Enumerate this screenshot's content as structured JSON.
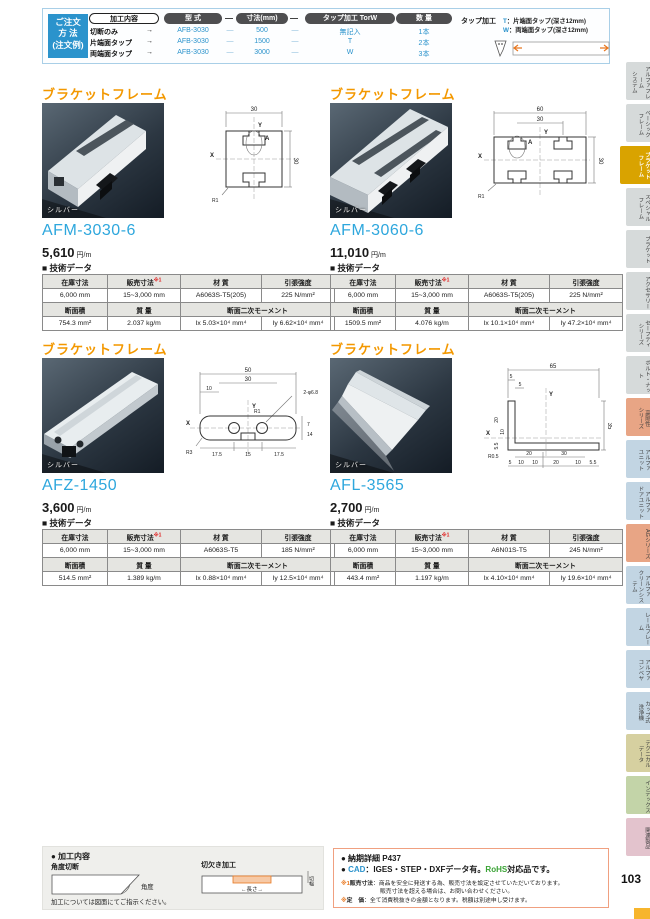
{
  "page": {
    "number": "103",
    "accent_orange": "#f39800",
    "accent_blue": "#2b93cc",
    "tab_active_bg": "#d9a300"
  },
  "order": {
    "box_label": "ご注文\n方 法\n(注文例)",
    "col_processing": "加工内容",
    "col_model": "型 式",
    "col_size": "寸法(mm)",
    "col_tap": "タップ加工 TorW",
    "col_qty": "数 量",
    "dash1": "—",
    "dash2": "—",
    "rows": [
      {
        "proc": "切断のみ",
        "arrow": "→",
        "model": "AFB-3030",
        "d1": "—",
        "size": "500",
        "d2": "—",
        "tap": "無記入",
        "qty": "1本"
      },
      {
        "proc": "片端面タップ",
        "arrow": "→",
        "model": "AFB-3030",
        "d1": "—",
        "size": "1500",
        "d2": "—",
        "tap": "T",
        "qty": "2本"
      },
      {
        "proc": "両端面タップ",
        "arrow": "→",
        "model": "AFB-3030",
        "d1": "—",
        "size": "3000",
        "d2": "—",
        "tap": "W",
        "qty": "3本"
      }
    ],
    "legend": {
      "title": "タップ加工",
      "t_key": "T",
      "t_text": "：片端面タップ(深さ12mm)",
      "w_key": "W",
      "w_text": "：両端面タップ(深さ12mm)"
    }
  },
  "products": [
    {
      "title": "ブラケットフレーム",
      "photo_label": "シルバー",
      "code": "AFM-3030-6",
      "price": "5,610",
      "unit": "円/m",
      "tech_heading": "■ 技術データ",
      "table": {
        "h1": "在庫寸法",
        "h2": "販売寸法",
        "h2_sup": "※1",
        "h3": "材 質",
        "h4": "引張強度",
        "v1": "6,000 mm",
        "v2": "15~3,000 mm",
        "v3": "A6063S-T5(205)",
        "v4": "225 N/mm²",
        "h5": "断面積",
        "h6": "質 量",
        "h7": "断面二次モーメント",
        "v5": "754.3 mm²",
        "v6": "2.037 kg/m",
        "v7a": "Ix 5.03×10⁴ mm⁴",
        "v7b": "Iy 6.62×10⁴ mm⁴"
      },
      "diagram": {
        "dim_w": "30",
        "dim_h": "30",
        "ax_x": "X",
        "ax_y": "Y",
        "pt_a": "A",
        "r": "R1"
      }
    },
    {
      "title": "ブラケットフレーム",
      "photo_label": "シルバー",
      "code": "AFM-3060-6",
      "price": "11,010",
      "unit": "円/m",
      "tech_heading": "■ 技術データ",
      "table": {
        "h1": "在庫寸法",
        "h2": "販売寸法",
        "h2_sup": "※1",
        "h3": "材 質",
        "h4": "引張強度",
        "v1": "6,000 mm",
        "v2": "15~3,000 mm",
        "v3": "A6063S-T5(205)",
        "v4": "225 N/mm²",
        "h5": "断面積",
        "h6": "質 量",
        "h7": "断面二次モーメント",
        "v5": "1509.5 mm²",
        "v6": "4.076 kg/m",
        "v7a": "Ix 10.1×10⁴ mm⁴",
        "v7b": "Iy 47.2×10⁴ mm⁴"
      },
      "diagram": {
        "dim_w": "60",
        "dim_inner": "30",
        "dim_h": "30",
        "ax_x": "X",
        "ax_y": "Y",
        "pt_a": "A",
        "r": "R1"
      }
    },
    {
      "title": "ブラケットフレーム",
      "photo_label": "シルバー",
      "code": "AFZ-1450",
      "price": "3,600",
      "unit": "円/m",
      "tech_heading": "■ 技術データ",
      "table": {
        "h1": "在庫寸法",
        "h2": "販売寸法",
        "h2_sup": "※1",
        "h3": "材 質",
        "h4": "引張強度",
        "v1": "6,000 mm",
        "v2": "15~3,000 mm",
        "v3": "A6063S-T5",
        "v4": "185 N/mm²",
        "h5": "断面積",
        "h6": "質 量",
        "h7": "断面二次モーメント",
        "v5": "514.5 mm²",
        "v6": "1.389 kg/m",
        "v7a": "Ix 0.88×10⁴ mm⁴",
        "v7b": "Iy 12.5×10⁴ mm⁴"
      },
      "diagram": {
        "dim_w": "50",
        "dim_mid": "30",
        "dim_s": "10",
        "hole": "2-φ6.8",
        "ax_x": "X",
        "ax_y": "Y",
        "b1": "17.5",
        "b2": "15",
        "b3": "17.5",
        "side": "14",
        "side2": "7",
        "r": "R3",
        "r2": "R1"
      }
    },
    {
      "title": "ブラケットフレーム",
      "photo_label": "シルバー",
      "code": "AFL-3565",
      "price": "2,700",
      "unit": "円/m",
      "tech_heading": "■ 技術データ",
      "table": {
        "h1": "在庫寸法",
        "h2": "販売寸法",
        "h2_sup": "※1",
        "h3": "材 質",
        "h4": "引張強度",
        "v1": "6,000 mm",
        "v2": "15~3,000 mm",
        "v3": "A6N01S-T5",
        "v4": "245 N/mm²",
        "h5": "断面積",
        "h6": "質 量",
        "h7": "断面二次モーメント",
        "v5": "443.4 mm²",
        "v6": "1.197 kg/m",
        "v7a": "Ix 4.10×10⁴ mm⁴",
        "v7b": "Iy 19.6×10⁴ mm⁴"
      },
      "diagram": {
        "dim_w": "65",
        "s1": "5",
        "s2": "5",
        "ax_x": "X",
        "ax_y": "Y",
        "side": "35",
        "b1": "20",
        "b2": "30",
        "c1": "5",
        "c2": "10",
        "c3": "10",
        "c4": "20",
        "c5": "10",
        "c6": "5.5",
        "l1": "20",
        "l2": "10",
        "l3": "5.5",
        "r": "R0.5"
      }
    }
  ],
  "sidebar": {
    "tabs": [
      {
        "label": "アルファフレーム\nシステム"
      },
      {
        "label": "ベーシック\nフレーム"
      },
      {
        "label": "ブラケット\nフレーム"
      },
      {
        "label": "スペシャル\nフレーム"
      },
      {
        "label": "ブラケット"
      },
      {
        "label": "アクセサリー"
      },
      {
        "label": "セーフティ\nシリーズ"
      },
      {
        "label": "ボルト・ナット"
      },
      {
        "label": "高剛性\nシリーズ"
      },
      {
        "label": "アルファ\nユニット"
      },
      {
        "label": "アルファ\nドアユニット"
      },
      {
        "label": "AGシリーズ"
      },
      {
        "label": "アルファ\nクリーンシステム"
      },
      {
        "label": "レールフレーム"
      },
      {
        "label": "アルファ\nコンベヤ"
      },
      {
        "label": "カップ式\n洗浄機"
      },
      {
        "label": "テクニカル\nデータ"
      },
      {
        "label": "インデックス"
      },
      {
        "label": "関連製品"
      }
    ]
  },
  "footer_left": {
    "title": "● 加工内容",
    "angle_title": "角度切断",
    "angle_label": "角度",
    "notch_title": "切欠き加工",
    "notch_width": "切幅",
    "notch_length": "←長さ→",
    "note": "加工については図面にてご指示ください。"
  },
  "footer_right": {
    "line1": "● 納期詳細 P437",
    "bullet2": "● ",
    "cad": "CAD",
    "cad_rest": "：IGES・STEP・DXFデータ有。",
    "rohs": "RoHS",
    "rohs_rest": "対応品です。",
    "n1_mark": "※1",
    "n1_label": "販売寸法",
    "n1_text": "：商品を安全に発送する為、販売寸法を設定させていただいております。",
    "n1_text2": "販売寸法を超える場合は、お問い合わせください。",
    "n2_mark": "※",
    "n2_label": "定　価",
    "n2_text": "：全て消費税抜きの金額となります。税額は別途申し受けます。"
  }
}
